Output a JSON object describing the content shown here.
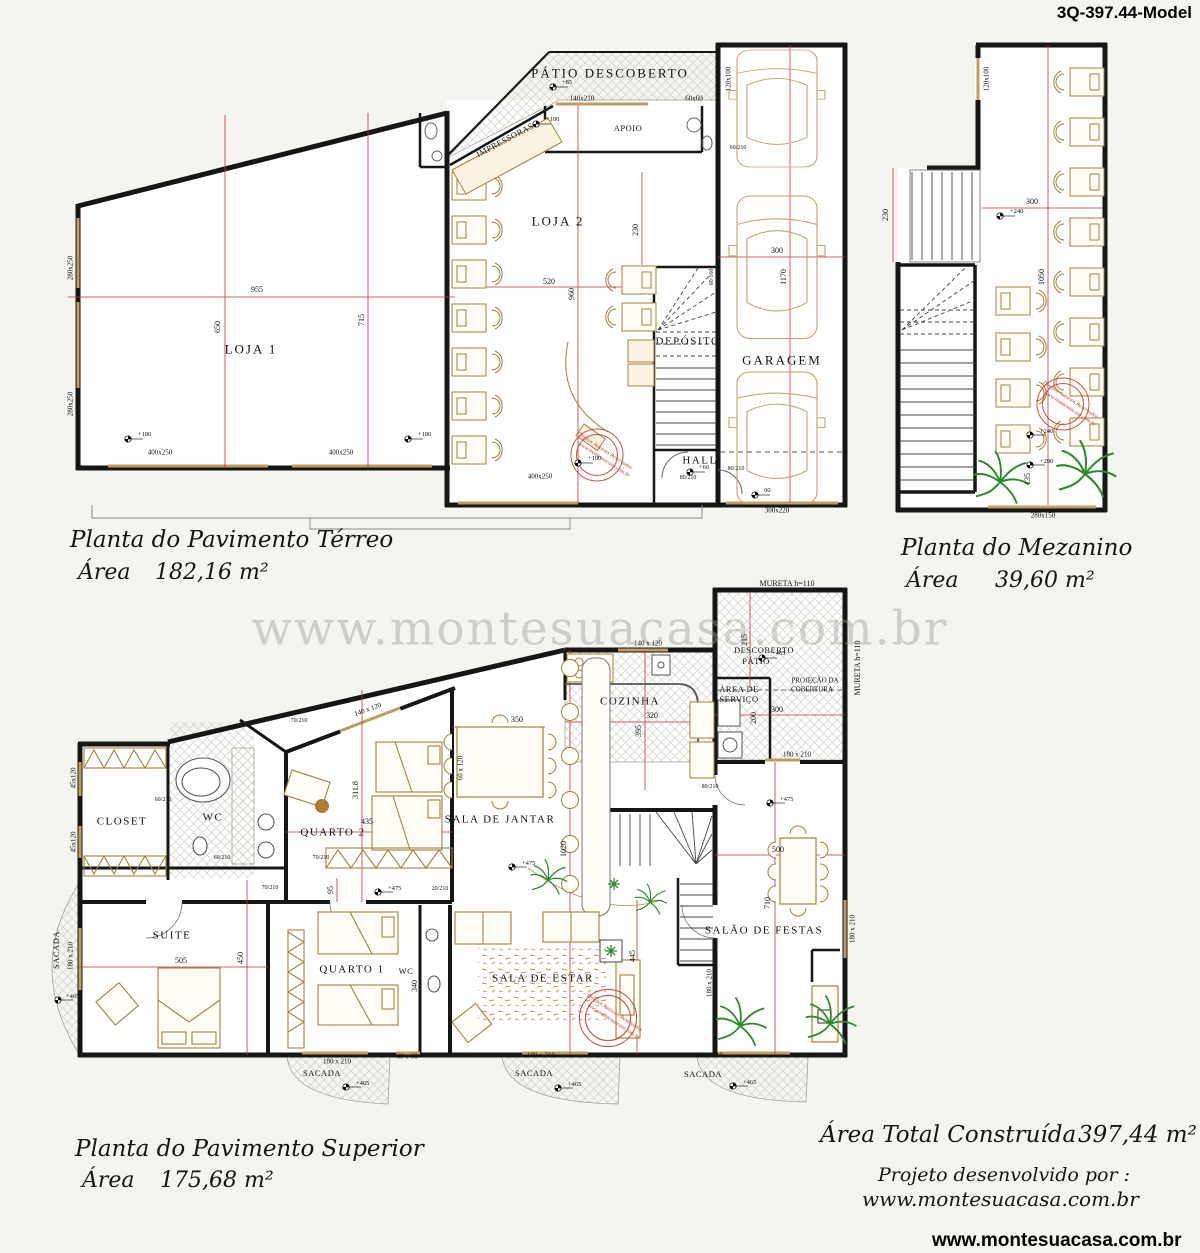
{
  "title": "3Q-397.44-Model",
  "watermark": "www.montesuacasa.com.br",
  "footer_url": "www.montesuacasa.com.br",
  "captions": {
    "terreo_title": "Planta do Pavimento Térreo",
    "terreo_area_label": "Área",
    "terreo_area_value": "182,16 m²",
    "mezanino_title": "Planta do Mezanino",
    "mezanino_area_label": "Área",
    "mezanino_area_value": "39,60 m²",
    "superior_title": "Planta do Pavimento Superior",
    "superior_area_label": "Área",
    "superior_area_value": "175,68 m²",
    "total_label": "Área Total Construída",
    "total_value": "397,44 m²",
    "credits_line1": "Projeto desenvolvido por :",
    "credits_line2": "www.montesuacasa.com.br"
  },
  "stamp": {
    "line1": "Direitos Autorais Reservados",
    "line2": "www.montesuacasa.com.br"
  },
  "rooms": {
    "patio_descoberto": "PÁTIO DESCOBERTO",
    "apoio": "APOIO",
    "impressoras": "IMPRESSORAS",
    "loja1": "LOJA 1",
    "loja2": "LOJA 2",
    "deposito": "DEPÓSITO",
    "garagem": "GARAGEM",
    "hall": "HALL",
    "cozinha": "COZINHA",
    "area_servico_l1": "ÁREA DE",
    "area_servico_l2": "SERVIÇO",
    "patio_sup_l1": "DESCOBERTO",
    "patio_sup_l2": "PÁTIO",
    "projecao_l1": "PROJEÇÃO DA",
    "projecao_l2": "COBERTURA",
    "sala_jantar": "SALA DE JANTAR",
    "quarto2": "QUARTO 2",
    "wc": "WC",
    "closet": "CLOSET",
    "suite": "SUITE",
    "quarto1": "QUARTO 1",
    "sala_estar": "SALA DE ESTAR",
    "salao_festas": "SALÃO DE FESTAS",
    "sacada": "SACADA",
    "mureta": "MURETA h=110"
  },
  "dims": {
    "d955": "955",
    "d650": "650",
    "d715": "715",
    "d520": "520",
    "d960": "960",
    "d230": "230",
    "d300": "300",
    "d1170": "1170",
    "d1050": "1050",
    "d135": "135",
    "d320": "320",
    "d395": "395",
    "d350": "350",
    "d1020": "1020",
    "d311_8": "311.8",
    "d435": "435",
    "d95": "95",
    "d505": "505",
    "d450": "450",
    "d445": "445",
    "d340": "340",
    "d500": "500",
    "d710": "710",
    "d200": "200",
    "d215": "215"
  },
  "openings": {
    "w280x250": "280x250",
    "w400x250": "400x250",
    "w140x210": "140x210",
    "w60x60": "60x60",
    "w120x100": "120x100",
    "w300x220": "300x220",
    "w280x150": "280x150",
    "w180x210": "180 x 210",
    "w140x120": "140 x 120",
    "w45x120": "45x120",
    "w60x120": "60 x 120",
    "w60x60sp": "60 x 60",
    "d60_210": "60/210",
    "d70_210": "70/210",
    "d80_210": "80/210",
    "d20_210": "20/210",
    "d60_160": "60/160"
  },
  "levels": {
    "p85": "+85",
    "p100": "+100",
    "p180": "+180",
    "p60": "+60",
    "zero": "00",
    "p240": "+240",
    "p290": "+290",
    "p465": "+465",
    "p475": "+475"
  }
}
